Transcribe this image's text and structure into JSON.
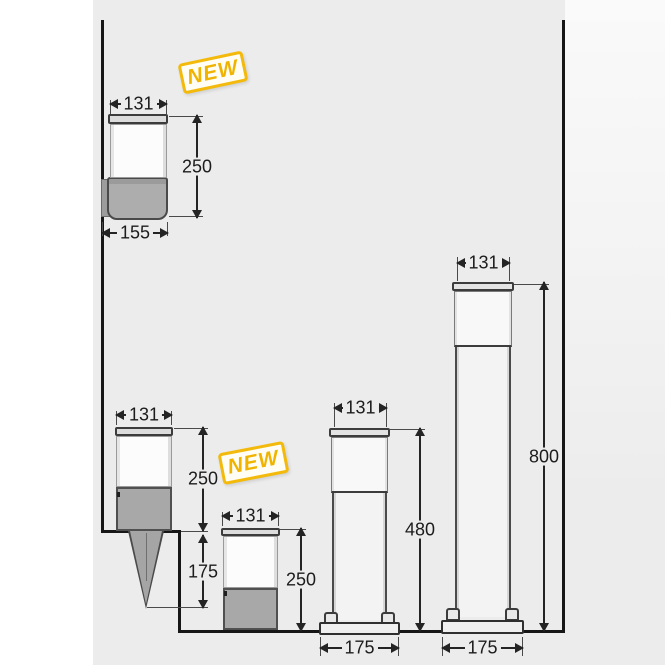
{
  "diagram": {
    "badge_top": "NEW",
    "badge_middle": "NEW",
    "wall_light": {
      "top_width": "131",
      "height": "250",
      "bottom_width": "155"
    },
    "spike_light": {
      "top_width": "131",
      "height": "250",
      "spike_depth": "175"
    },
    "small_bollard": {
      "top_width": "131",
      "height": "250"
    },
    "medium_bollard": {
      "top_width": "131",
      "height": "480",
      "base_width": "175"
    },
    "tall_bollard": {
      "top_width": "131",
      "height": "800",
      "base_width": "175"
    },
    "colors": {
      "background": "#ececec",
      "outline": "#161616",
      "badge_yellow": "#f0b400",
      "body_gray": "#a8a8a8"
    }
  }
}
